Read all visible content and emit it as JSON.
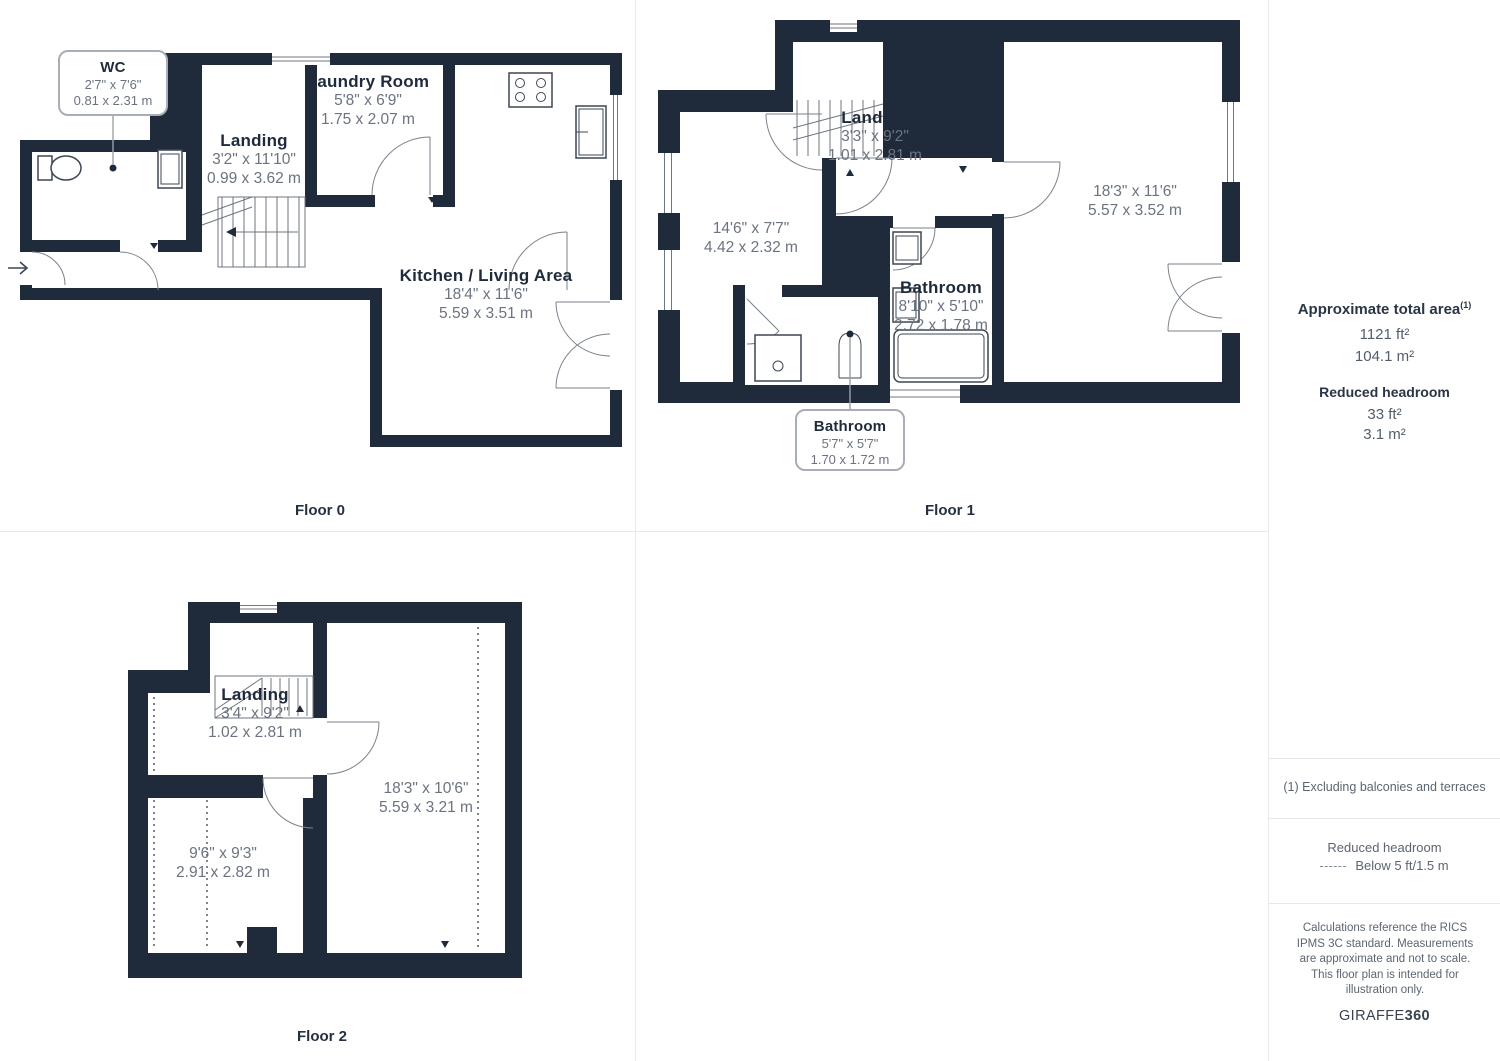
{
  "colors": {
    "wall": "#1F2B3B",
    "dim_text": "#6B7380",
    "divider": "#E6E8EA"
  },
  "floor0": {
    "label": "Floor 0",
    "wc": {
      "name": "WC",
      "imperial": "2'7\" x 7'6\"",
      "metric": "0.81 x 2.31 m"
    },
    "landing": {
      "name": "Landing",
      "imperial": "3'2\" x 11'10\"",
      "metric": "0.99 x 3.62 m"
    },
    "laundry": {
      "name": "Laundry Room",
      "imperial": "5'8\" x 6'9\"",
      "metric": "1.75 x 2.07 m"
    },
    "kitchen": {
      "name": "Kitchen / Living Area",
      "imperial": "18'4\" x 11'6\"",
      "metric": "5.59 x 3.51 m"
    }
  },
  "floor1": {
    "label": "Floor 1",
    "landing": {
      "name": "Landing",
      "imperial": "3'3\" x 9'2\"",
      "metric": "1.01 x 2.81 m"
    },
    "room_left": {
      "imperial": "14'6\" x 7'7\"",
      "metric": "4.42 x 2.32 m"
    },
    "room_right": {
      "imperial": "18'3\" x 11'6\"",
      "metric": "5.57 x 3.52 m"
    },
    "bathroom": {
      "name": "Bathroom",
      "imperial": "8'10\" x 5'10\"",
      "metric": "2.72 x 1.78 m"
    },
    "bathroom_small": {
      "name": "Bathroom",
      "imperial": "5'7\" x 5'7\"",
      "metric": "1.70 x 1.72 m"
    }
  },
  "floor2": {
    "label": "Floor 2",
    "landing": {
      "name": "Landing",
      "imperial": "3'4\" x 9'2\"",
      "metric": "1.02 x 2.81 m"
    },
    "room_left": {
      "imperial": "9'6\" x 9'3\"",
      "metric": "2.91 x 2.82 m"
    },
    "room_right": {
      "imperial": "18'3\" x 10'6\"",
      "metric": "5.59 x 3.21 m"
    }
  },
  "sidebar": {
    "total_area_label": "Approximate total area",
    "total_area_footnote_mark": "(1)",
    "total_area_ft": "1121 ft²",
    "total_area_m": "104.1 m²",
    "reduced_headroom_label": "Reduced headroom",
    "reduced_headroom_ft": "33 ft²",
    "reduced_headroom_m": "3.1 m²",
    "footnote": "(1) Excluding balconies and terraces",
    "legend_title": "Reduced headroom",
    "legend_value": "Below 5 ft/1.5 m",
    "disclaimer": "Calculations reference the RICS IPMS 3C standard. Measurements are approximate and not to scale. This floor plan is intended for illustration only.",
    "brand_regular": "GIRAFFE",
    "brand_bold": "360"
  }
}
